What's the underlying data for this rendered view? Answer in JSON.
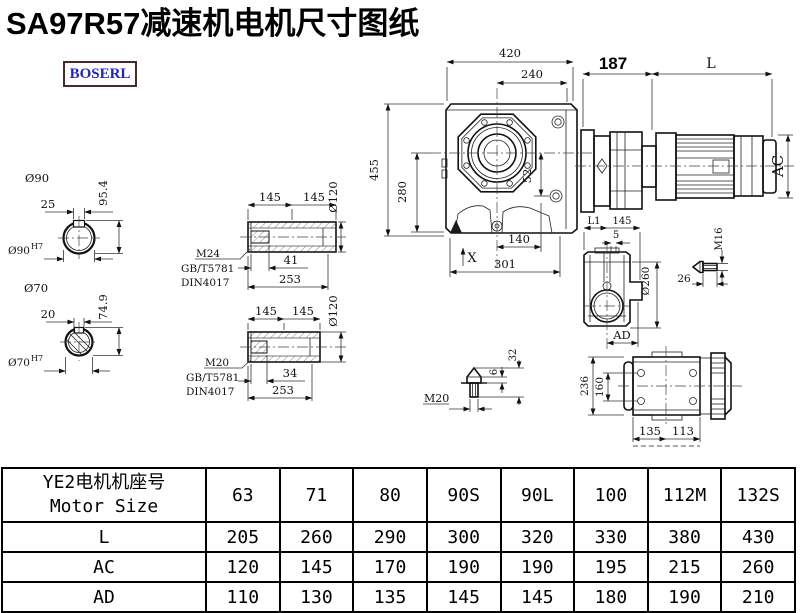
{
  "title": "SA97R57减速机电机尺寸图纸",
  "logo": "BOSERL",
  "dims": {
    "d420": "420",
    "d240": "240",
    "d187": "187",
    "dL": "L",
    "d455": "455",
    "d280": "280",
    "d52": "52",
    "d140": "140",
    "d301": "301",
    "dX": "X",
    "dAC": "AC",
    "s90_dia": "Ø90",
    "s90_key": "25",
    "s90_h": "95.4",
    "s90_bore": "Ø90",
    "s90_fit": "H7",
    "s70_dia": "Ø70",
    "s70_key": "20",
    "s70_h": "74.9",
    "s70_bore": "Ø70",
    "s70_fit": "H7",
    "ha_l1": "145",
    "ha_l2": "145",
    "ha_dia": "Ø120",
    "ha_key": "41",
    "ha_total": "253",
    "ha_thread": "M24",
    "ha_std1": "GB/T5781",
    "ha_std2": "DIN4017",
    "hb_l1": "145",
    "hb_l2": "145",
    "hb_dia": "Ø120",
    "hb_key": "34",
    "hb_total": "253",
    "hb_thread": "M20",
    "hb_std1": "GB/T5781",
    "hb_std2": "DIN4017",
    "sv_l1": "L1",
    "sv_145": "145",
    "sv_5": "5",
    "sv_dia": "Ø260",
    "sv_ad": "AD",
    "b16_thread": "M16",
    "b16_len": "26",
    "b20_thread": "M20",
    "b20_6": "6",
    "b20_32": "32",
    "tv_236": "236",
    "tv_160": "160",
    "tv_135": "135",
    "tv_113": "113"
  },
  "table": {
    "header_line1": "YE2电机机座号",
    "header_line2": "Motor Size",
    "columns": [
      "63",
      "71",
      "80",
      "90S",
      "90L",
      "100",
      "112M",
      "132S"
    ],
    "rows": [
      {
        "label": "L",
        "values": [
          "205",
          "260",
          "290",
          "300",
          "320",
          "330",
          "380",
          "430"
        ]
      },
      {
        "label": "AC",
        "values": [
          "120",
          "145",
          "170",
          "190",
          "190",
          "195",
          "215",
          "260"
        ]
      },
      {
        "label": "AD",
        "values": [
          "110",
          "130",
          "135",
          "145",
          "145",
          "180",
          "190",
          "210"
        ]
      }
    ]
  }
}
